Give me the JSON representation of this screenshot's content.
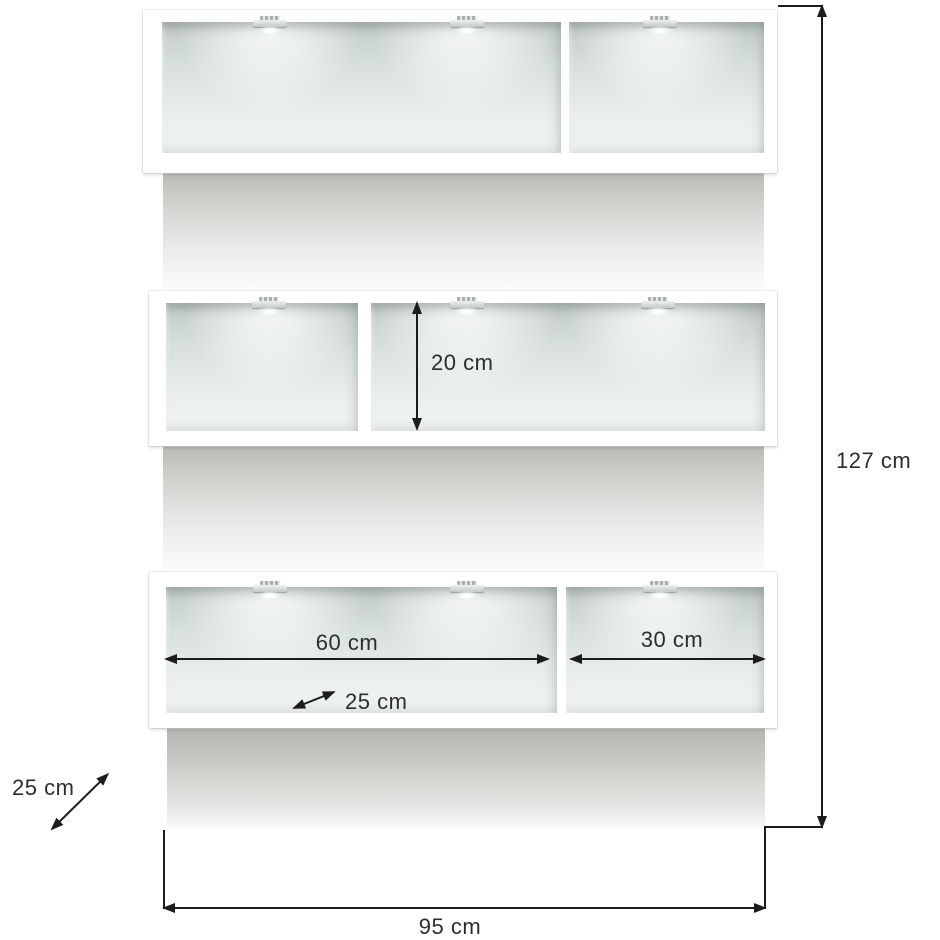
{
  "diagram": {
    "title": "Wall-mounted shelf unit with LED lighting — dimension diagram",
    "rows": 3,
    "lights_per_row": [
      3,
      3,
      3
    ],
    "labels": {
      "total_height": "127 cm",
      "total_width": "95 cm",
      "depth": "25 cm",
      "inner_height": "20 cm",
      "inner_width_left": "60 cm",
      "inner_width_right": "30 cm",
      "inner_depth": "25 cm"
    },
    "colors": {
      "background": "#ffffff",
      "cabinet": "#ffffff",
      "dimension_line": "#1c1c1c",
      "label_text": "#2d2d2d",
      "interior_glow": "#e9f1ef",
      "wall_shadow": "#b5b8b3"
    }
  }
}
